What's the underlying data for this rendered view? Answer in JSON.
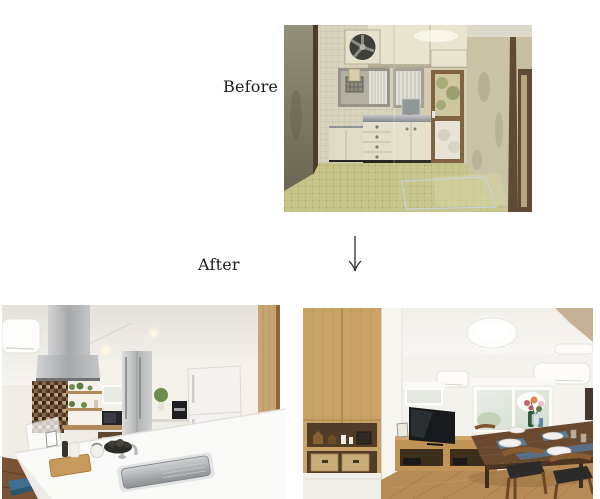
{
  "page": {
    "background": "#ffffff",
    "width": 600,
    "height": 499
  },
  "labels": {
    "before": "Before",
    "after": "After"
  },
  "arrow": {
    "direction": "down",
    "color": "#1a1a1a"
  },
  "photos": {
    "before": {
      "alt": "Old dated kitchen: cream cabinets, stainless counter, barred window, glass back door, yellow-green tiled floor, dark wood trim",
      "palette": {
        "wall": "#c7bfa0",
        "side_wall": "#8f8c74",
        "trim": "#54402a",
        "cabinet": "#e4dfca",
        "counter_steel": "#9aa0a4",
        "floor_tile": "#c6c489",
        "door_frame": "#7b5b39"
      }
    },
    "after_kitchen": {
      "alt": "Renovated kitchen: white island counter with stainless sink, steel range hood, brown mosaic backsplash, white refrigerator, wood pillar",
      "palette": {
        "wall": "#f4f1ea",
        "hood_steel": "#b9babc",
        "mosaic": "#6b4f35",
        "counter": "#f9f9f7",
        "fridge": "#f3f2ef",
        "wood_floor": "#7a5236",
        "pillar_wood": "#c9a671"
      }
    },
    "after_living": {
      "alt": "Renovated living-dining room: oak storage wall, TV on low wooden board, dining table with blue mats and plates, wood floor, round ceiling light",
      "palette": {
        "cabinet_wood": "#c9a268",
        "wall": "#f4f2ec",
        "table": "#6a4a2f",
        "placemat": "#5b7b97",
        "floor": "#b78a57",
        "tv": "#17191b"
      }
    }
  }
}
